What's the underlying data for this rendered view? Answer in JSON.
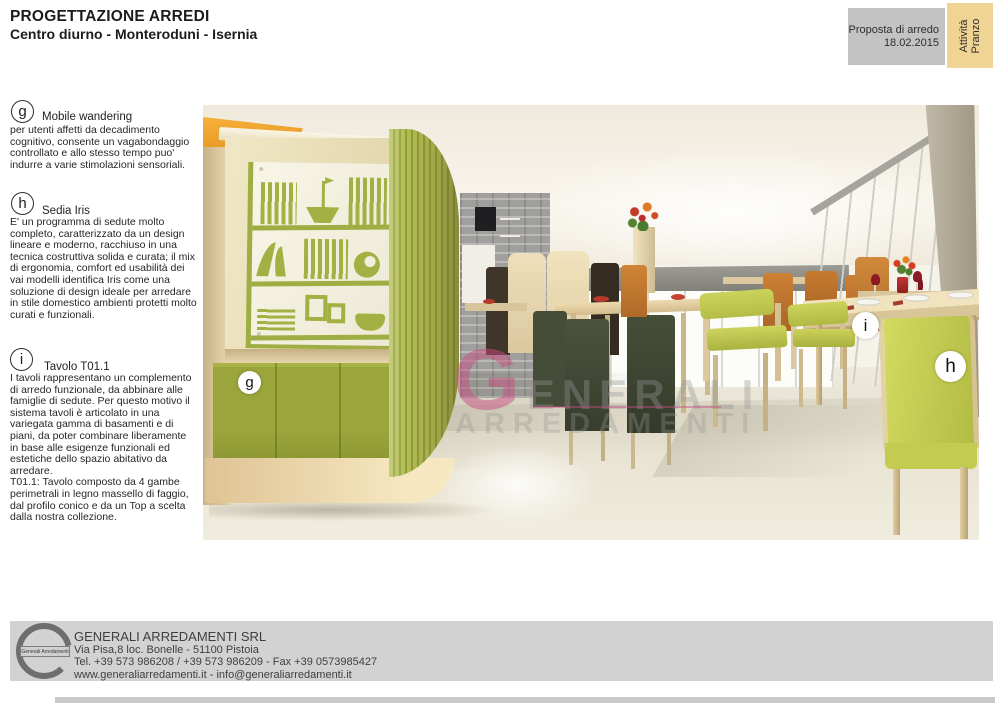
{
  "header": {
    "title": "PROGETTAZIONE ARREDI",
    "subtitle": "Centro diurno - Monteroduni - Isernia"
  },
  "proposal_box": {
    "line1": "Proposta di arredo",
    "line2": "18.02.2015"
  },
  "activity_tab": {
    "line1": "Attività",
    "line2": "Pranzo"
  },
  "annotations": [
    {
      "letter": "g",
      "title": "Mobile wandering",
      "body": "per utenti affetti da decadimento cognitivo, consente un vagabondaggio  controllato e allo stesso tempo puo' indurre a varie stimolazioni sensoriali."
    },
    {
      "letter": "h",
      "title": "Sedia Iris",
      "body": "E' un programma di sedute molto completo, caratterizzato da un design lineare e moderno, racchiuso in una tecnica costruttiva solida e curata; il mix di ergonomia, comfort ed usabilità dei vai modelli identifica Iris come una soluzione di design ideale per arredare in stile domestico ambienti protetti molto curati e funzionali."
    },
    {
      "letter": "i",
      "title": "Tavolo T01.1",
      "body": "I tavoli rappresentano un complemento di arredo funzionale, da abbinare alle famiglie di sedute. Per questo motivo il sistema tavoli è articolato in una variegata gamma di basamenti e di piani, da poter combinare liberamente in base alle esigenze funzionali ed estetiche dello spazio abitativo da arredare.",
      "body2": "T01.1: Tavolo composto da 4 gambe perimetrali in legno massello di faggio, dal profilo conico e da un Top a scelta dalla nostra collezione."
    }
  ],
  "render": {
    "markers": [
      {
        "letter": "g"
      },
      {
        "letter": "i"
      },
      {
        "letter": "h"
      }
    ],
    "watermark": {
      "line1": "GENERALI",
      "line2": "ARREDAMENTI"
    }
  },
  "footer": {
    "logo_text": "Generali Arredamenti",
    "company": "GENERALI ARREDAMENTI SRL",
    "address": "Via Pisa,8 loc. Bonelle - 51100 Pistoia",
    "phone": "Tel. +39 573 986208 / +39 573 986209 - Fax +39 0573985427",
    "web": "www.generaliarredamenti.it - info@generaliarredamenti.it"
  },
  "colors": {
    "accent_green": "#9fae42",
    "cabinet_cream": "#ece0b8",
    "accent_orange": "#f2a833",
    "tab_yellow": "#f0d494",
    "proposal_gray": "#c3c3c3",
    "footer_gray": "#d2d2d2",
    "watermark_pink": "#c74d80"
  }
}
